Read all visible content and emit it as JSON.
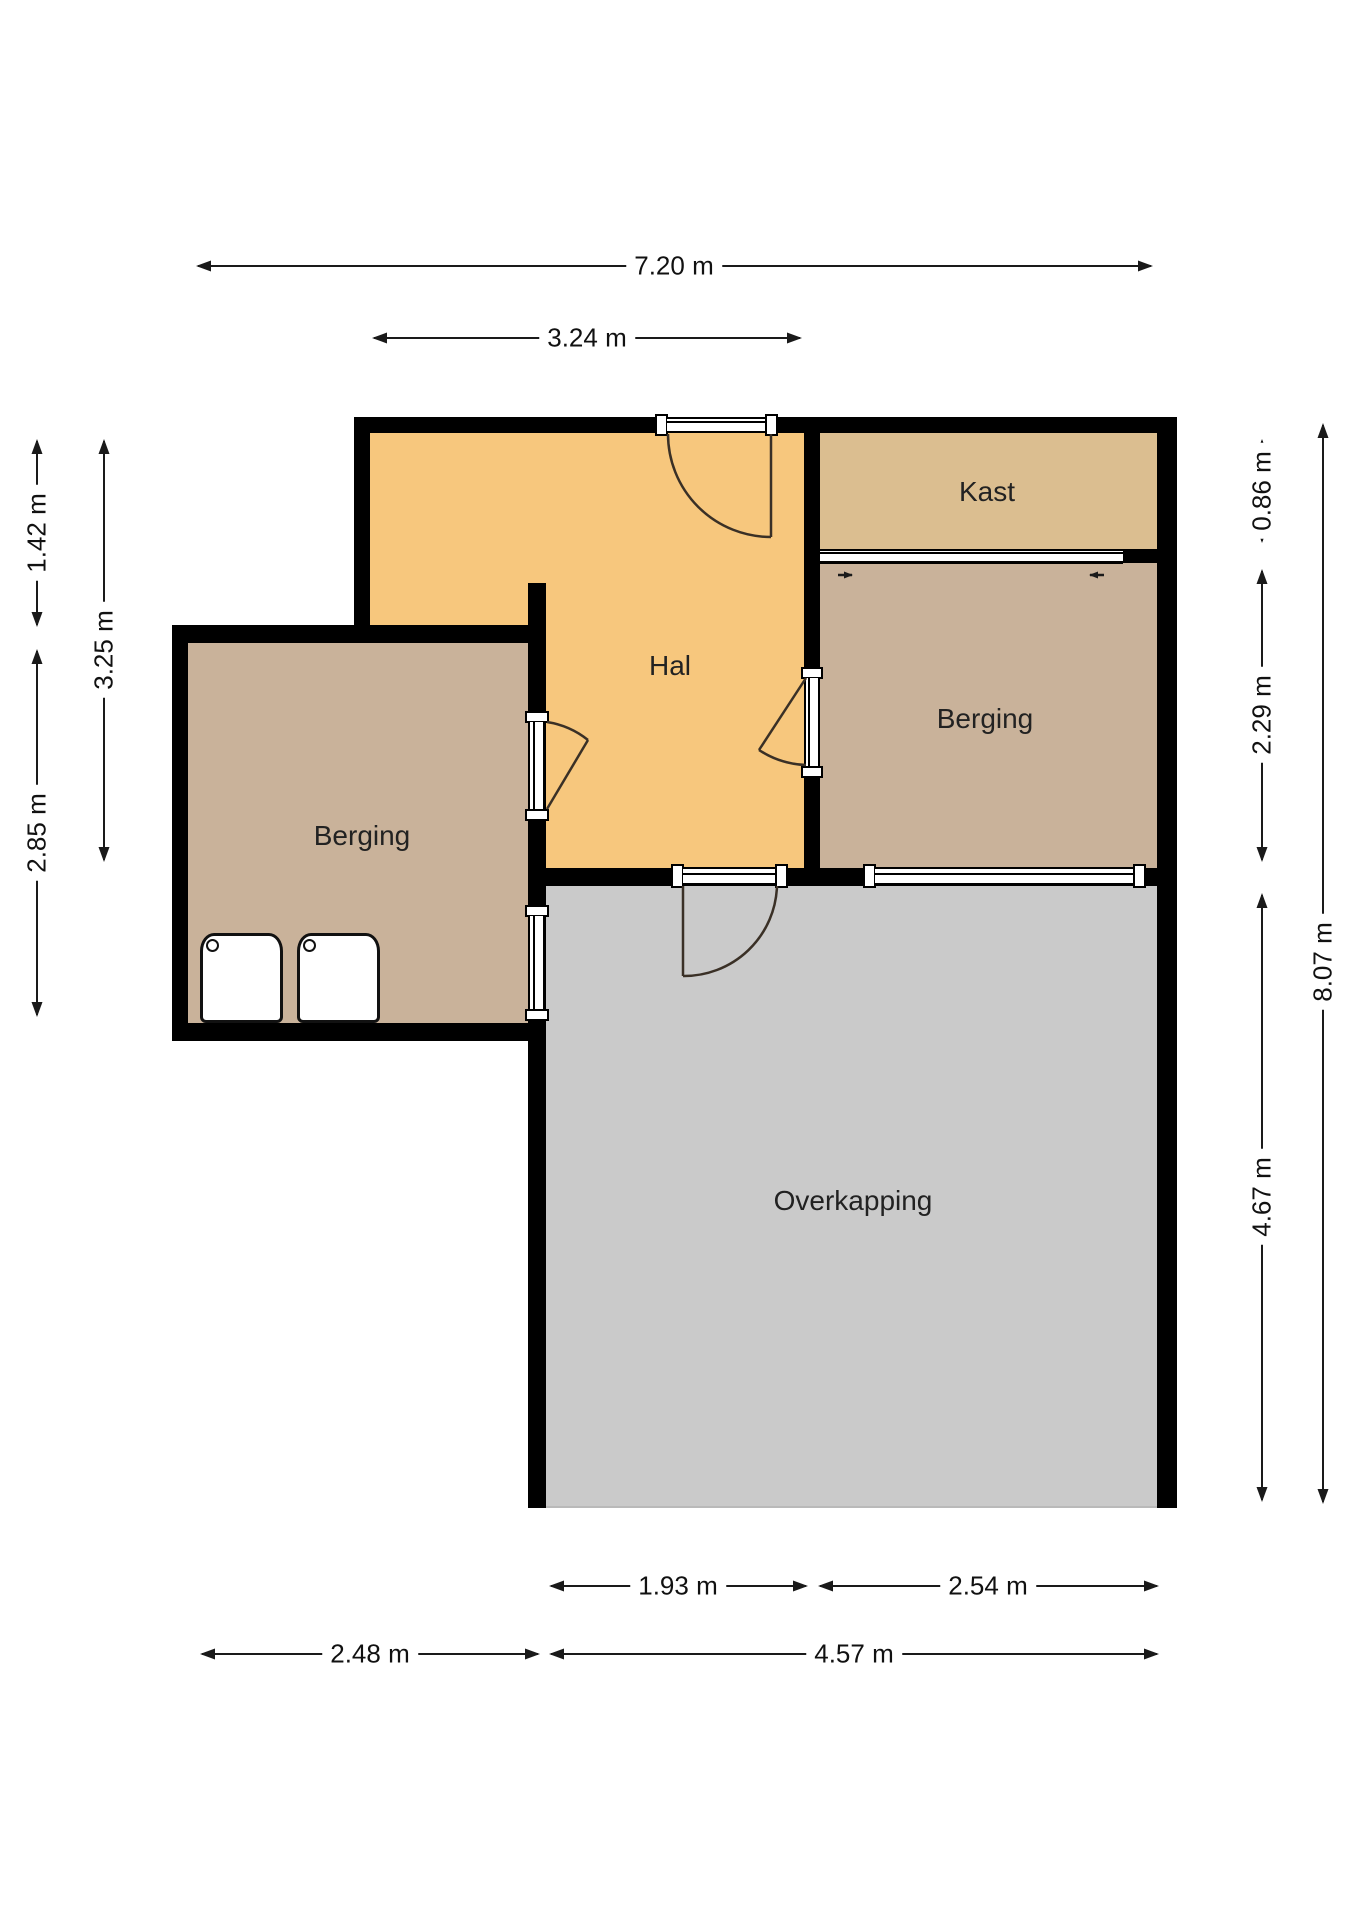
{
  "plan": {
    "kind": "floor-plan"
  },
  "rooms": {
    "hal": {
      "label": "Hal"
    },
    "kast": {
      "label": "Kast"
    },
    "berging_right": {
      "label": "Berging"
    },
    "berging_left": {
      "label": "Berging"
    },
    "overkapping": {
      "label": "Overkapping"
    }
  },
  "dimensions": {
    "top_total": "7.20 m",
    "top_hal_width": "3.24 m",
    "left_top_offset": "1.42 m",
    "left_hal_height": "3.25 m",
    "left_berging_height": "2.85 m",
    "right_kast_depth": "0.86 m",
    "right_berging_height": "2.29 m",
    "right_overkapping_height": "4.67 m",
    "right_total_height": "8.07 m",
    "bottom_overkapping_left": "1.93 m",
    "bottom_overkapping_right": "2.54 m",
    "bottom_berging_width": "2.48 m",
    "bottom_overkapping_width": "4.57 m"
  },
  "icons": {
    "sliding_door_left_arrow": "right-small-arrow",
    "sliding_door_right_arrow": "left-small-arrow"
  },
  "colors": {
    "wall": "#000000",
    "hal_floor": "#F7C77D",
    "kast_floor": "#DBBE90",
    "berging_floor": "#C9B29A",
    "overkapping_floor": "#CACACA",
    "door_swing": "#3A3026",
    "dimension": "#1A1A1A"
  }
}
